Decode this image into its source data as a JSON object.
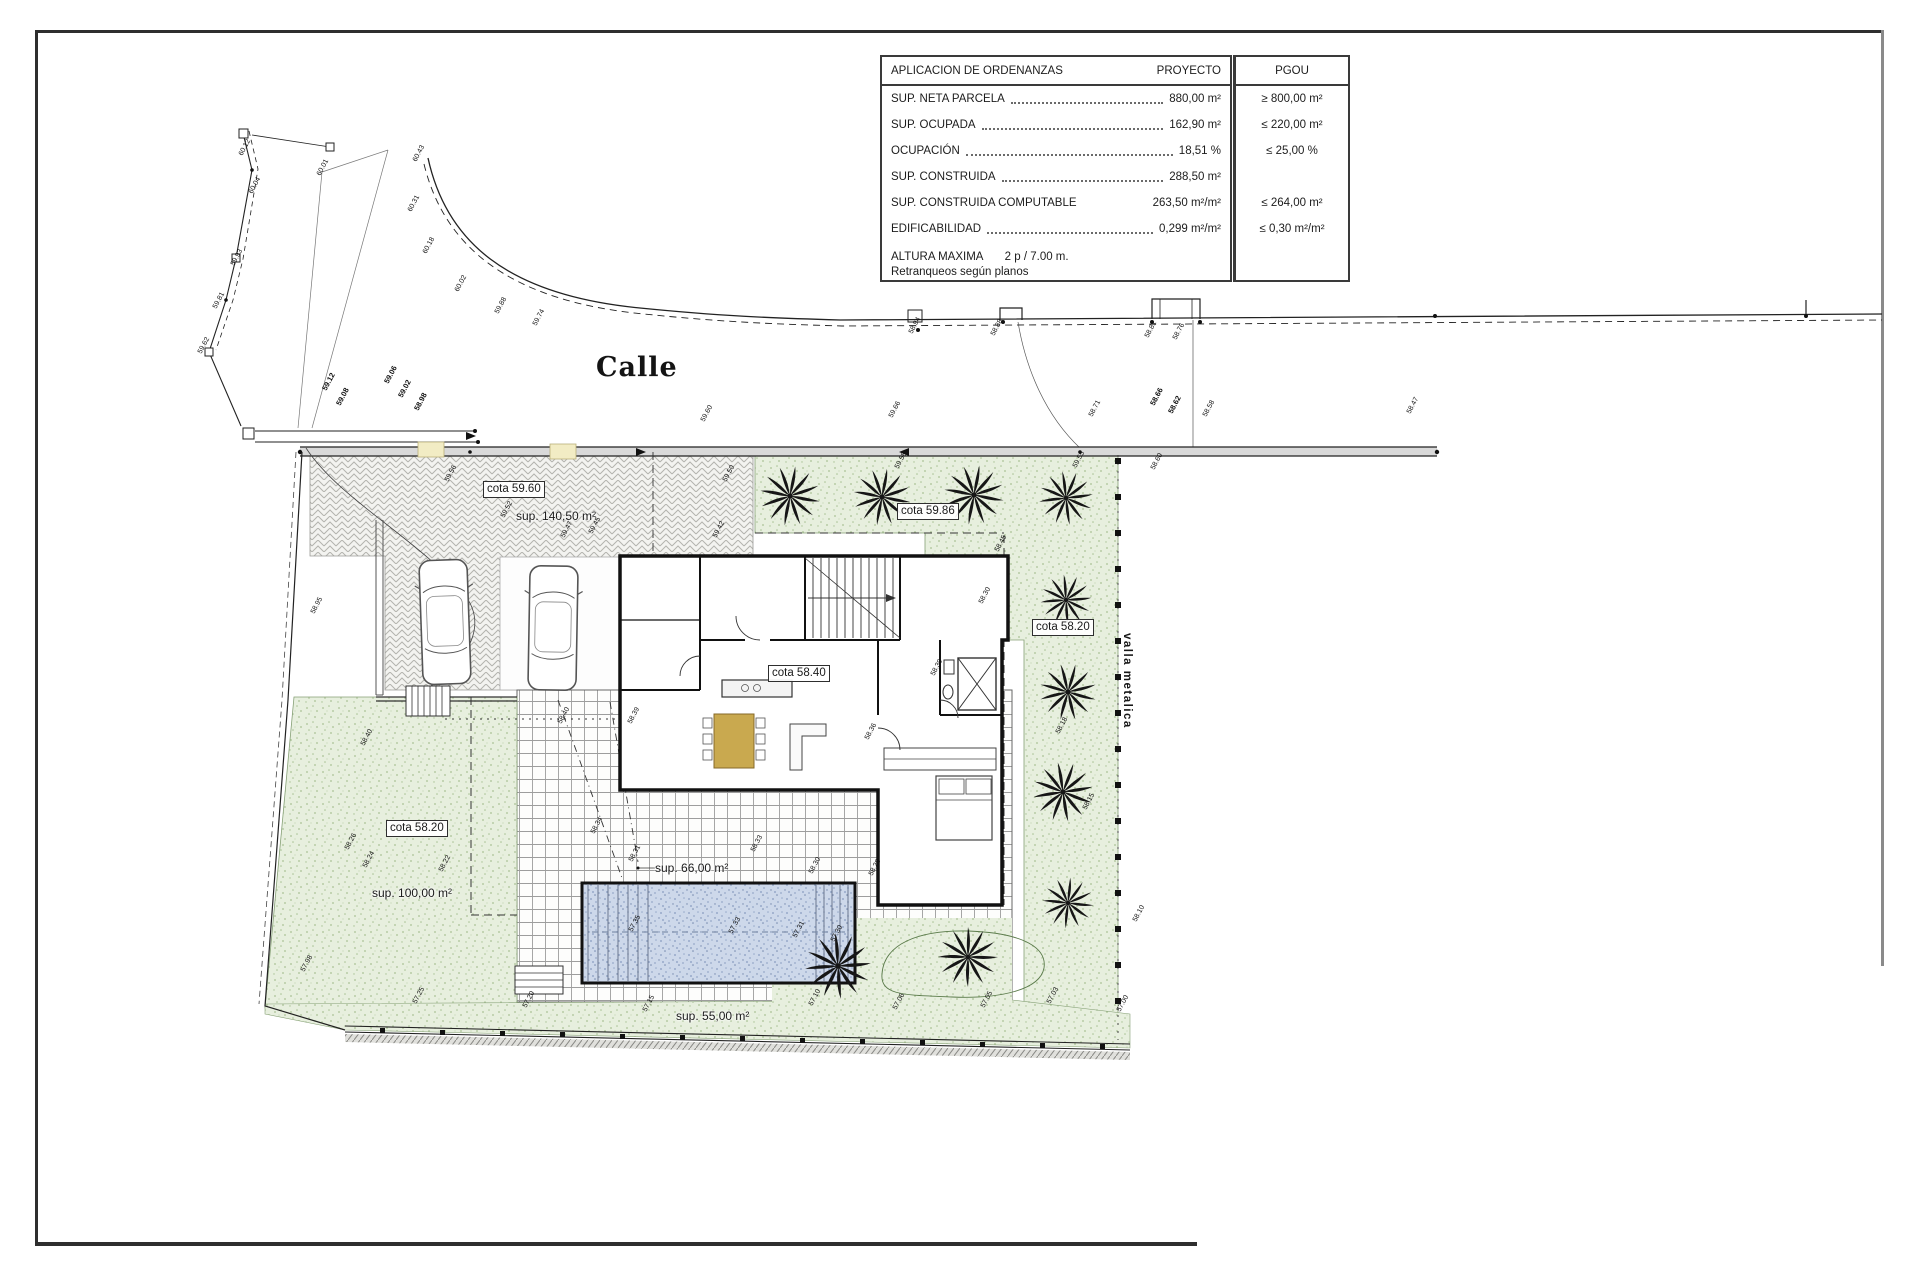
{
  "table": {
    "header": {
      "left": "APLICACION DE ORDENANZAS",
      "proyecto": "PROYECTO",
      "pgou": "PGOU"
    },
    "rows": [
      {
        "label": "SUP. NETA PARCELA",
        "dots": true,
        "proyecto": "880,00 m²",
        "pgou": "≥ 800,00 m²"
      },
      {
        "label": "SUP. OCUPADA",
        "dots": true,
        "proyecto": "162,90 m²",
        "pgou": "≤ 220,00 m²"
      },
      {
        "label": "OCUPACIÓN",
        "dots": true,
        "proyecto": "18,51 %",
        "pgou": "≤ 25,00 %"
      },
      {
        "label": "SUP. CONSTRUIDA",
        "dots": true,
        "proyecto": "288,50 m²",
        "pgou": ""
      },
      {
        "label": "SUP. CONSTRUIDA COMPUTABLE",
        "dots": false,
        "proyecto": "263,50 m²/m²",
        "pgou": "≤ 264,00 m²"
      },
      {
        "label": "EDIFICABILIDAD",
        "dots": true,
        "proyecto": "0,299 m²/m²",
        "pgou": "≤ 0,30 m²/m²"
      }
    ],
    "footer": {
      "label": "ALTURA MAXIMA",
      "value": "2 p / 7.00 m.",
      "note": "Retranqueos según planos"
    }
  },
  "plan": {
    "street_label": "Calle",
    "fence_label": "valla metalica"
  },
  "labels": {
    "cotas": [
      {
        "text": "cota 59.60",
        "x": 483,
        "y": 481
      },
      {
        "text": "cota 59.86",
        "x": 897,
        "y": 503
      },
      {
        "text": "cota 58.20",
        "x": 1032,
        "y": 619
      },
      {
        "text": "cota 58.40",
        "x": 768,
        "y": 665
      },
      {
        "text": "cota 58.20",
        "x": 386,
        "y": 820
      }
    ],
    "areas": [
      {
        "text": "sup. 140,50 m²",
        "x": 516,
        "y": 509
      },
      {
        "text": "sup. 100,00 m²",
        "x": 372,
        "y": 886
      },
      {
        "text": "sup. 66,00 m²",
        "x": 655,
        "y": 861
      },
      {
        "text": "sup. 55,00 m²",
        "x": 676,
        "y": 1009
      }
    ],
    "spots": [
      {
        "v": "60.12",
        "x": 244,
        "y": 150
      },
      {
        "v": "60.04",
        "x": 254,
        "y": 188
      },
      {
        "v": "59.93",
        "x": 236,
        "y": 260
      },
      {
        "v": "59.81",
        "x": 218,
        "y": 303
      },
      {
        "v": "59.62",
        "x": 203,
        "y": 348
      },
      {
        "v": "60.01",
        "x": 322,
        "y": 170
      },
      {
        "v": "59.12",
        "x": 328,
        "y": 383,
        "b": 1
      },
      {
        "v": "59.08",
        "x": 342,
        "y": 398,
        "b": 1
      },
      {
        "v": "60.43",
        "x": 418,
        "y": 156
      },
      {
        "v": "60.31",
        "x": 413,
        "y": 206
      },
      {
        "v": "60.18",
        "x": 428,
        "y": 248
      },
      {
        "v": "60.02",
        "x": 460,
        "y": 286
      },
      {
        "v": "59.88",
        "x": 500,
        "y": 308
      },
      {
        "v": "59.74",
        "x": 538,
        "y": 320
      },
      {
        "v": "59.06",
        "x": 390,
        "y": 376,
        "b": 1
      },
      {
        "v": "59.02",
        "x": 404,
        "y": 390,
        "b": 1
      },
      {
        "v": "58.98",
        "x": 420,
        "y": 403,
        "b": 1
      },
      {
        "v": "59.60",
        "x": 706,
        "y": 416
      },
      {
        "v": "59.66",
        "x": 894,
        "y": 412
      },
      {
        "v": "58.94",
        "x": 914,
        "y": 328
      },
      {
        "v": "58.88",
        "x": 996,
        "y": 330
      },
      {
        "v": "58.81",
        "x": 1150,
        "y": 332
      },
      {
        "v": "58.76",
        "x": 1178,
        "y": 334
      },
      {
        "v": "58.71",
        "x": 1094,
        "y": 411
      },
      {
        "v": "58.66",
        "x": 1156,
        "y": 398,
        "b": 1
      },
      {
        "v": "58.62",
        "x": 1174,
        "y": 406,
        "b": 1
      },
      {
        "v": "58.58",
        "x": 1208,
        "y": 411
      },
      {
        "v": "58.47",
        "x": 1412,
        "y": 408
      },
      {
        "v": "59.56",
        "x": 450,
        "y": 476
      },
      {
        "v": "59.52",
        "x": 506,
        "y": 512
      },
      {
        "v": "59.47",
        "x": 566,
        "y": 532
      },
      {
        "v": "59.45",
        "x": 594,
        "y": 528
      },
      {
        "v": "59.42",
        "x": 718,
        "y": 532
      },
      {
        "v": "59.50",
        "x": 728,
        "y": 476
      },
      {
        "v": "59.58",
        "x": 900,
        "y": 463
      },
      {
        "v": "59.55",
        "x": 1078,
        "y": 462
      },
      {
        "v": "58.60",
        "x": 1156,
        "y": 464
      },
      {
        "v": "58.45",
        "x": 1000,
        "y": 546
      },
      {
        "v": "58.30",
        "x": 984,
        "y": 598
      },
      {
        "v": "58.18",
        "x": 1061,
        "y": 728
      },
      {
        "v": "58.15",
        "x": 1088,
        "y": 804
      },
      {
        "v": "58.10",
        "x": 1138,
        "y": 916
      },
      {
        "v": "58.95",
        "x": 316,
        "y": 608
      },
      {
        "v": "58.40",
        "x": 366,
        "y": 740
      },
      {
        "v": "58.26",
        "x": 350,
        "y": 844
      },
      {
        "v": "58.24",
        "x": 368,
        "y": 862
      },
      {
        "v": "58.22",
        "x": 444,
        "y": 866
      },
      {
        "v": "57.98",
        "x": 306,
        "y": 966
      },
      {
        "v": "58.40",
        "x": 563,
        "y": 718
      },
      {
        "v": "58.39",
        "x": 633,
        "y": 718
      },
      {
        "v": "58.34",
        "x": 596,
        "y": 828
      },
      {
        "v": "58.31",
        "x": 634,
        "y": 856
      },
      {
        "v": "58.33",
        "x": 756,
        "y": 846
      },
      {
        "v": "58.30",
        "x": 814,
        "y": 868
      },
      {
        "v": "58.28",
        "x": 874,
        "y": 870
      },
      {
        "v": "57.35",
        "x": 634,
        "y": 926
      },
      {
        "v": "57.33",
        "x": 734,
        "y": 928
      },
      {
        "v": "57.31",
        "x": 798,
        "y": 932
      },
      {
        "v": "57.30",
        "x": 836,
        "y": 936
      },
      {
        "v": "58.39",
        "x": 936,
        "y": 670
      },
      {
        "v": "58.36",
        "x": 870,
        "y": 734
      },
      {
        "v": "57.25",
        "x": 418,
        "y": 998
      },
      {
        "v": "57.20",
        "x": 528,
        "y": 1002
      },
      {
        "v": "57.15",
        "x": 648,
        "y": 1006
      },
      {
        "v": "57.10",
        "x": 814,
        "y": 1000
      },
      {
        "v": "57.06",
        "x": 898,
        "y": 1004
      },
      {
        "v": "57.05",
        "x": 986,
        "y": 1002
      },
      {
        "v": "57.03",
        "x": 1052,
        "y": 998
      },
      {
        "v": "57.00",
        "x": 1122,
        "y": 1006
      }
    ]
  },
  "colors": {
    "line": "#1a1a1a",
    "garden": "#e7efde",
    "garden_dot": "#a9c295",
    "pool": "#cdd8ea",
    "pool_dot": "#97a9c9",
    "drive": "#f3f3f0",
    "drive_line": "#b3b3ae",
    "grid": "#9d9d9d",
    "sidewalk": "#d9d9d9",
    "table_wood": "#c9a94f"
  }
}
